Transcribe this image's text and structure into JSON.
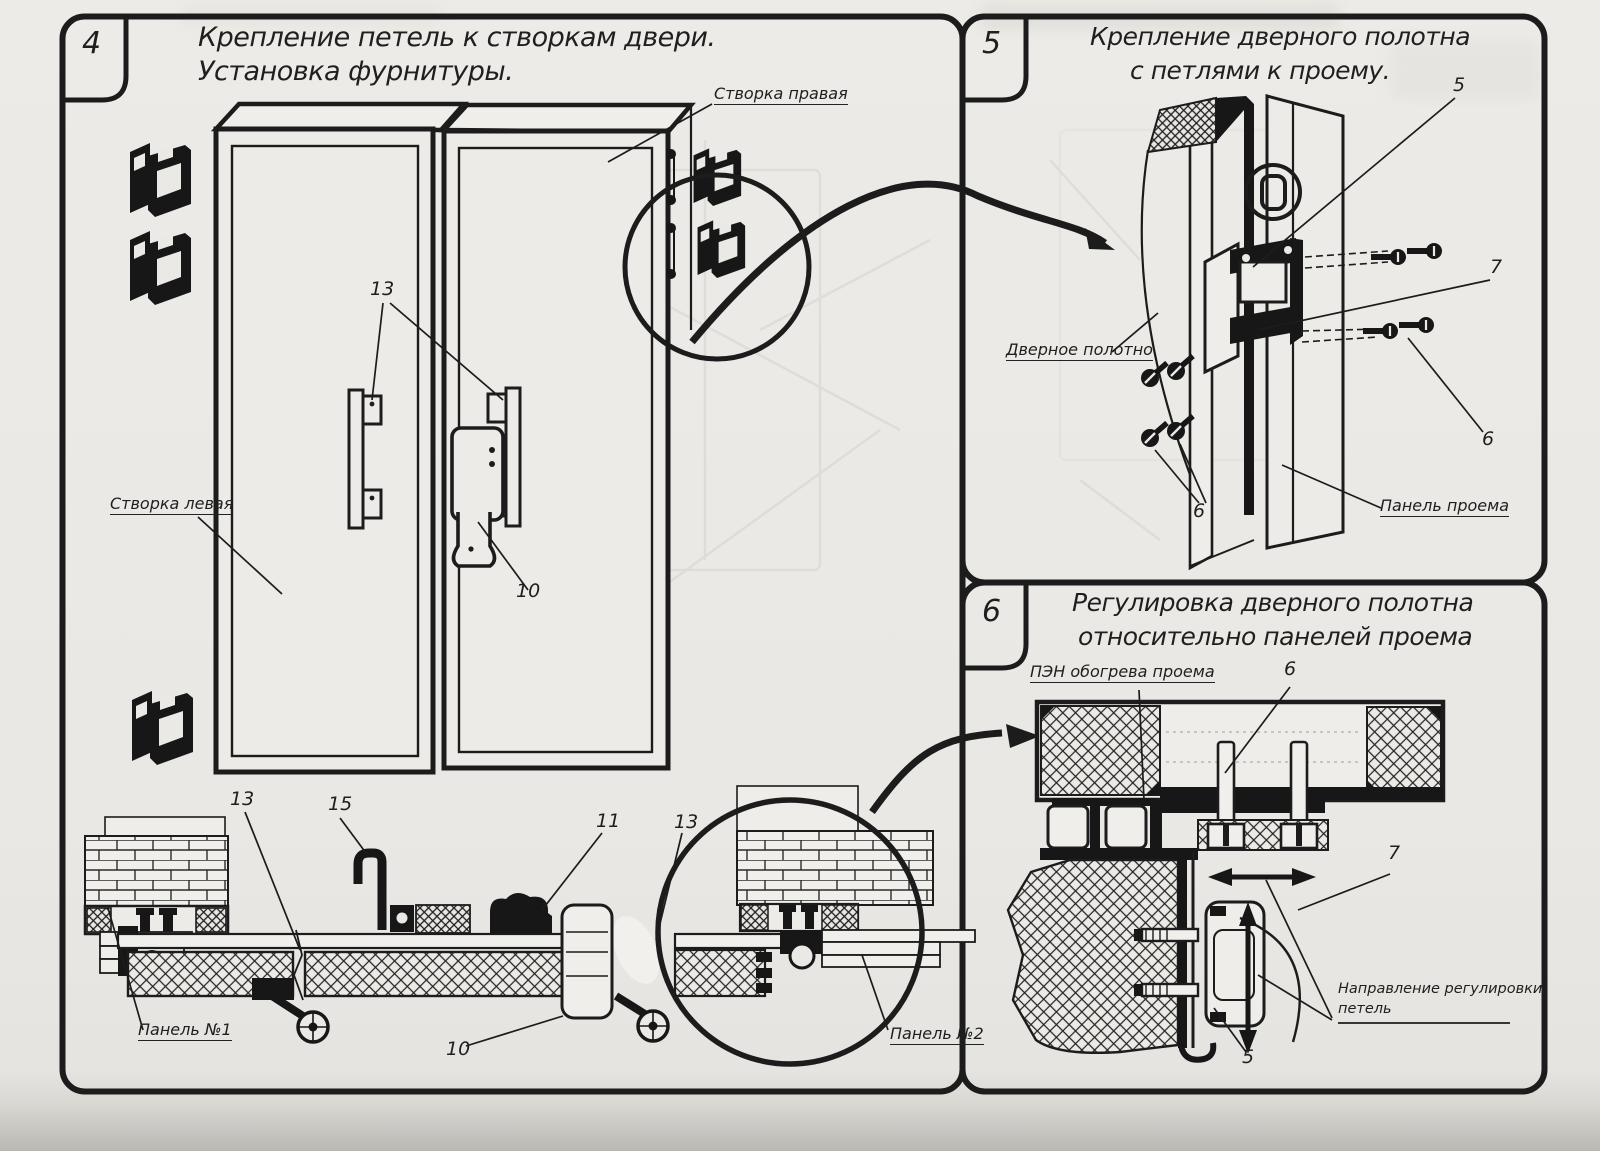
{
  "p4": {
    "number": "4",
    "title": [
      "Крепление петель к створкам двери.",
      "Установка фурнитуры."
    ],
    "labels": {
      "leaf_right": "Створка правая",
      "leaf_left": "Створка левая",
      "panel_no1": "Панель №1",
      "panel_no2": "Панель №2"
    },
    "callouts": {
      "handles": "13",
      "latch": "10",
      "sec_13": "13",
      "sec_15": "15",
      "sec_11": "11",
      "sec_13b": "13",
      "sec_10": "10"
    }
  },
  "p5": {
    "number": "5",
    "title": [
      "Крепление дверного полотна",
      "с петлями к проему."
    ],
    "labels": {
      "door_leaf": "Дверное полотно",
      "opening_panel": "Панель проема"
    },
    "callouts": {
      "c5": "5",
      "c7": "7",
      "c6_right": "6",
      "c6_bottom": "6"
    }
  },
  "p6": {
    "number": "6",
    "title": [
      "Регулировка дверного полотна",
      "относительно панелей проема"
    ],
    "labels": {
      "pen": "ПЭН обогрева проема",
      "direction": [
        "Направление регулировки",
        "петель"
      ]
    },
    "callouts": {
      "c6": "6",
      "c7": "7",
      "c5": "5"
    }
  },
  "colors": {
    "paper": "#ebe9e5",
    "ink": "#1c1c1c"
  }
}
